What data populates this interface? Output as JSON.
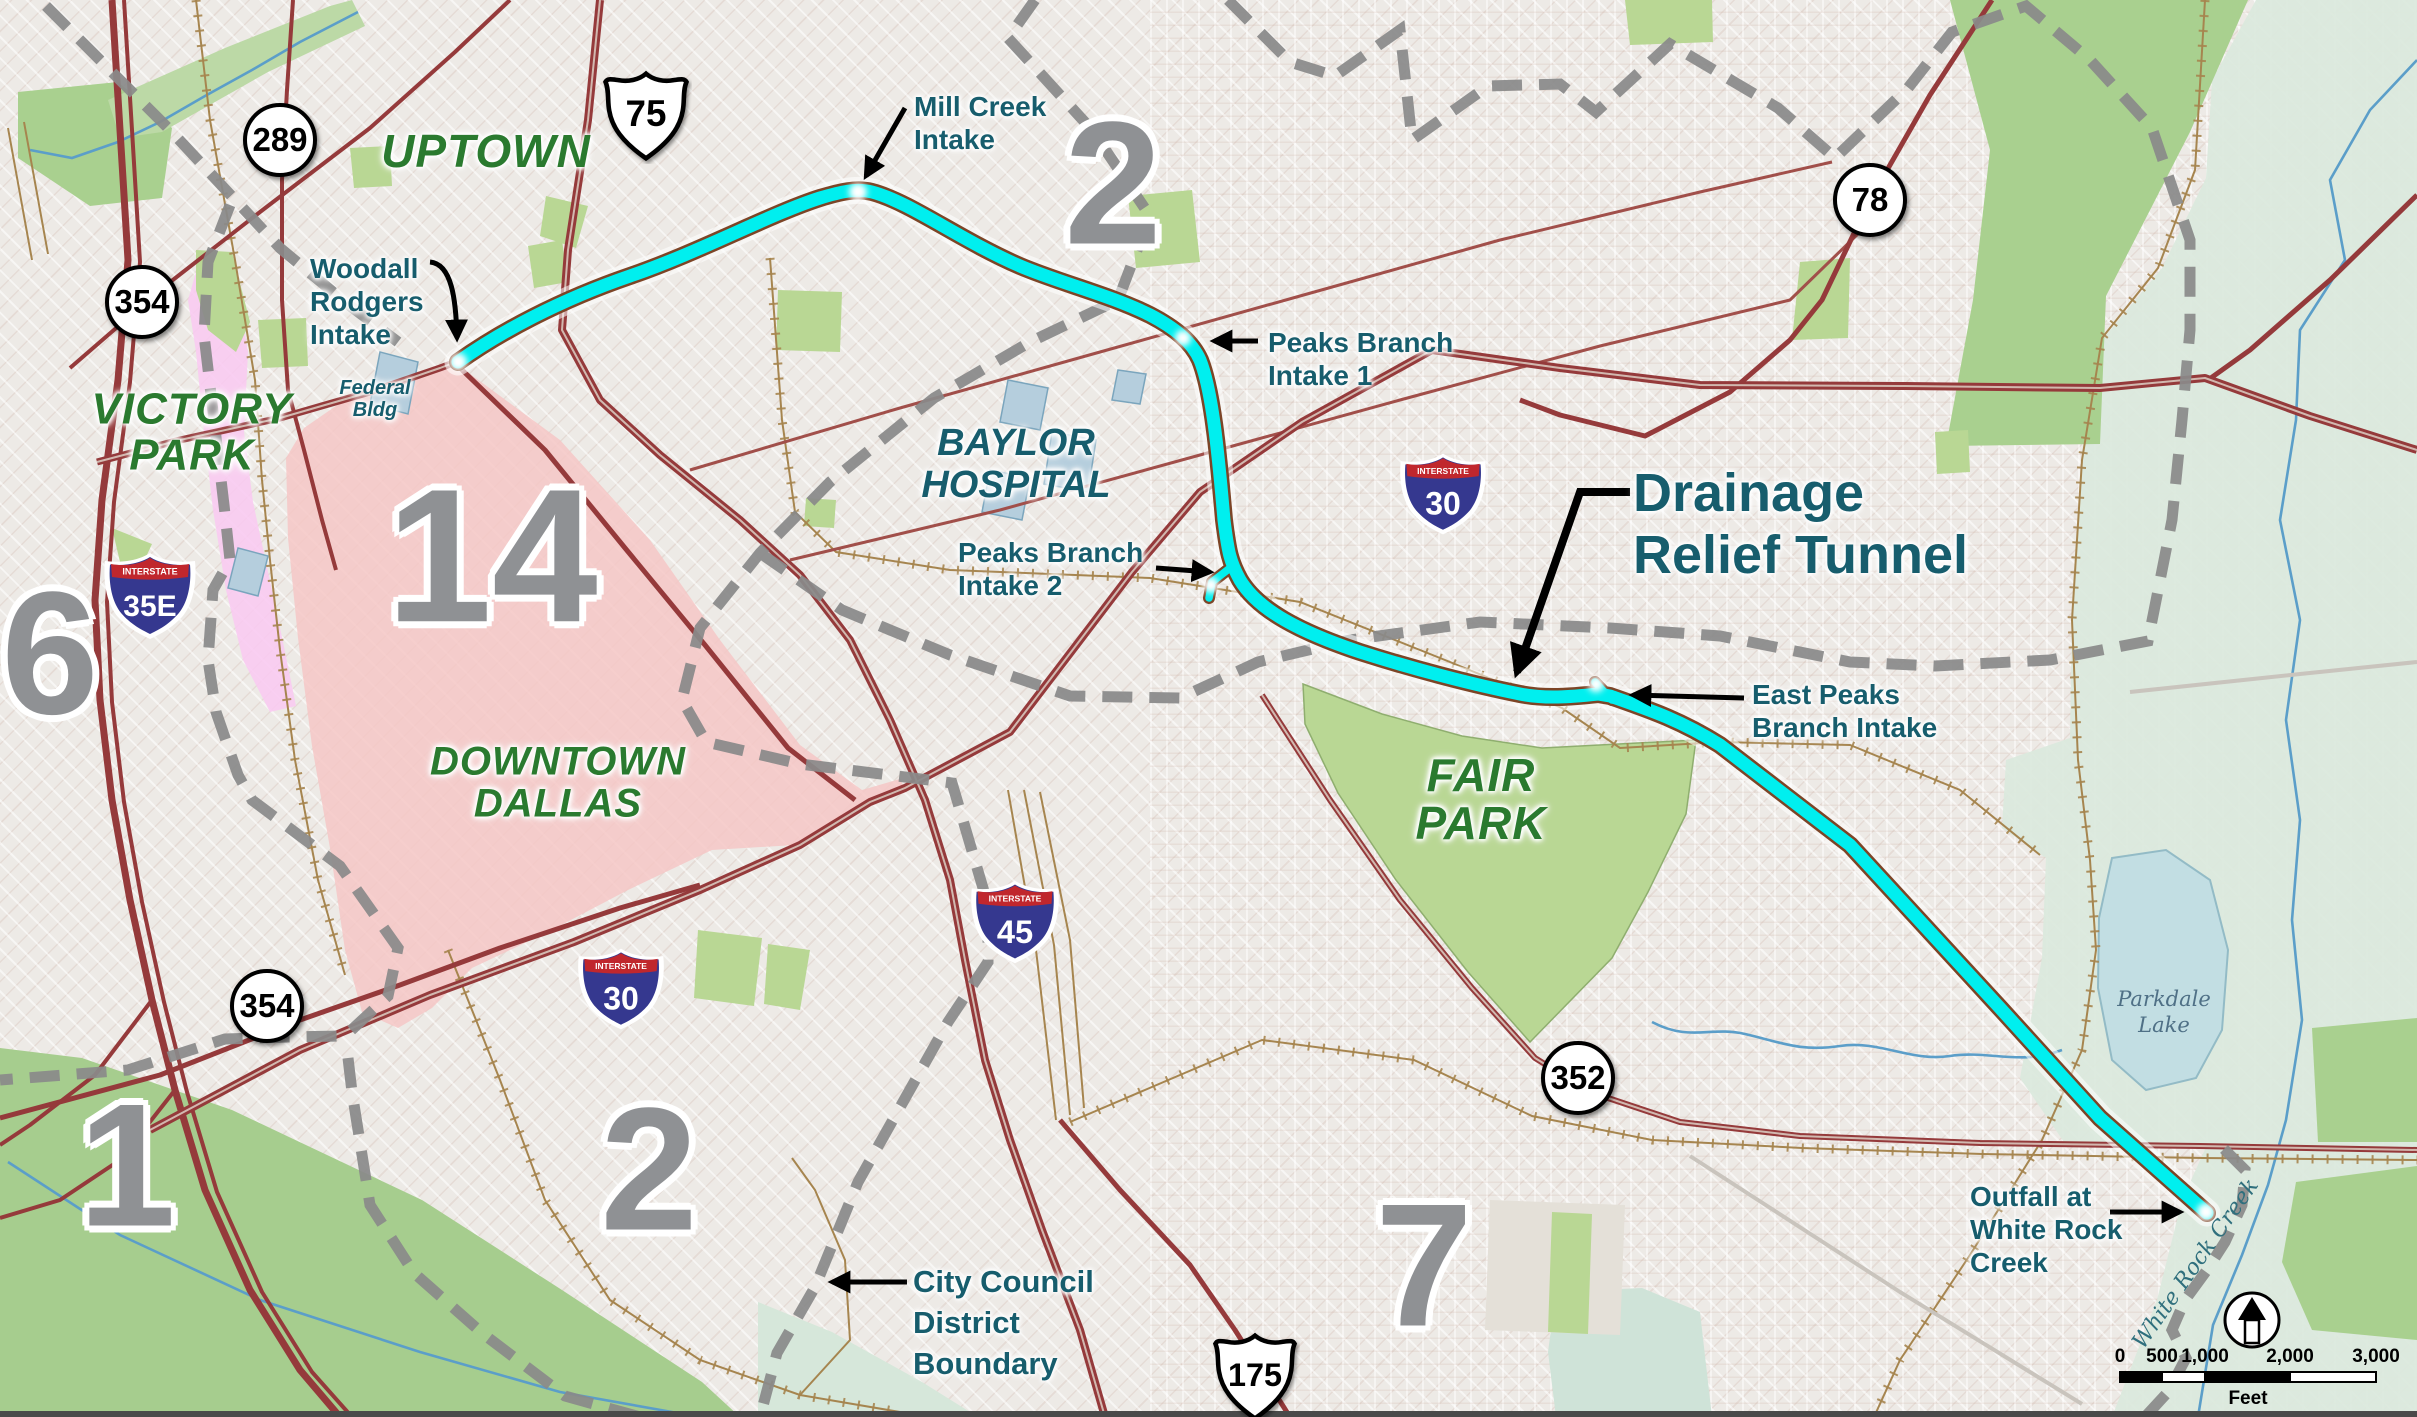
{
  "map_title": "Dallas Drainage Relief Tunnel map",
  "areas": {
    "uptown": {
      "label": "UPTOWN"
    },
    "victory_park": {
      "l1": "VICTORY",
      "l2": "PARK"
    },
    "downtown": {
      "l1": "DOWNTOWN",
      "l2": "DALLAS"
    },
    "fair_park": {
      "l1": "FAIR",
      "l2": "PARK"
    },
    "baylor": {
      "l1": "BAYLOR",
      "l2": "HOSPITAL"
    },
    "federal_bldg": {
      "l1": "Federal",
      "l2": "Bldg"
    },
    "parkdale_lake": {
      "l1": "Parkdale",
      "l2": "Lake"
    },
    "white_rock_creek": {
      "label": "White Rock Creek"
    }
  },
  "annotations": {
    "mill_creek": {
      "l1": "Mill Creek",
      "l2": "Intake"
    },
    "woodall": {
      "l1": "Woodall",
      "l2": "Rodgers",
      "l3": "Intake"
    },
    "peaks1": {
      "l1": "Peaks Branch",
      "l2": "Intake 1"
    },
    "peaks2": {
      "l1": "Peaks Branch",
      "l2": "Intake 2"
    },
    "east_peaks": {
      "l1": "East Peaks",
      "l2": "Branch Intake"
    },
    "tunnel": {
      "l1": "Drainage",
      "l2": "Relief Tunnel"
    },
    "outfall": {
      "l1": "Outfall at",
      "l2": "White Rock",
      "l3": "Creek"
    },
    "boundary": {
      "l1": "City Council",
      "l2": "District",
      "l3": "Boundary"
    }
  },
  "districts": {
    "d1": "1",
    "d2_north": "2",
    "d2_south": "2",
    "d6": "6",
    "d7": "7",
    "d14": "14"
  },
  "shields": {
    "interstate_word": "INTERSTATE",
    "i35e": "35E",
    "i30_east": "30",
    "i30_downtown": "30",
    "i45": "45",
    "us75": "75",
    "us175": "175",
    "c289": "289",
    "c354_north": "354",
    "c354_south": "354",
    "c352": "352",
    "c78": "78"
  },
  "scale_bar": {
    "t0": "0",
    "t500": "500",
    "t1000": "1,000",
    "t2000": "2,000",
    "t3000": "3,000",
    "unit": "Feet"
  },
  "colors": {
    "tunnel_cyan": "#00efef",
    "tunnel_casing": "#7c4527",
    "district_boundary_gray": "#8a8a8a",
    "downtown_pink": "#f5c6c5",
    "victory_magenta": "#f9c9f1",
    "park_green": "#b9d794",
    "floodplain_green": "#dbe9dd",
    "lake_blue": "#c2dee3",
    "road_red": "#953a3b",
    "railroad_tan": "#a6854f",
    "label_green": "#2a7a2f",
    "label_teal": "#175d6d",
    "district_number_gray": "#8f9194"
  }
}
